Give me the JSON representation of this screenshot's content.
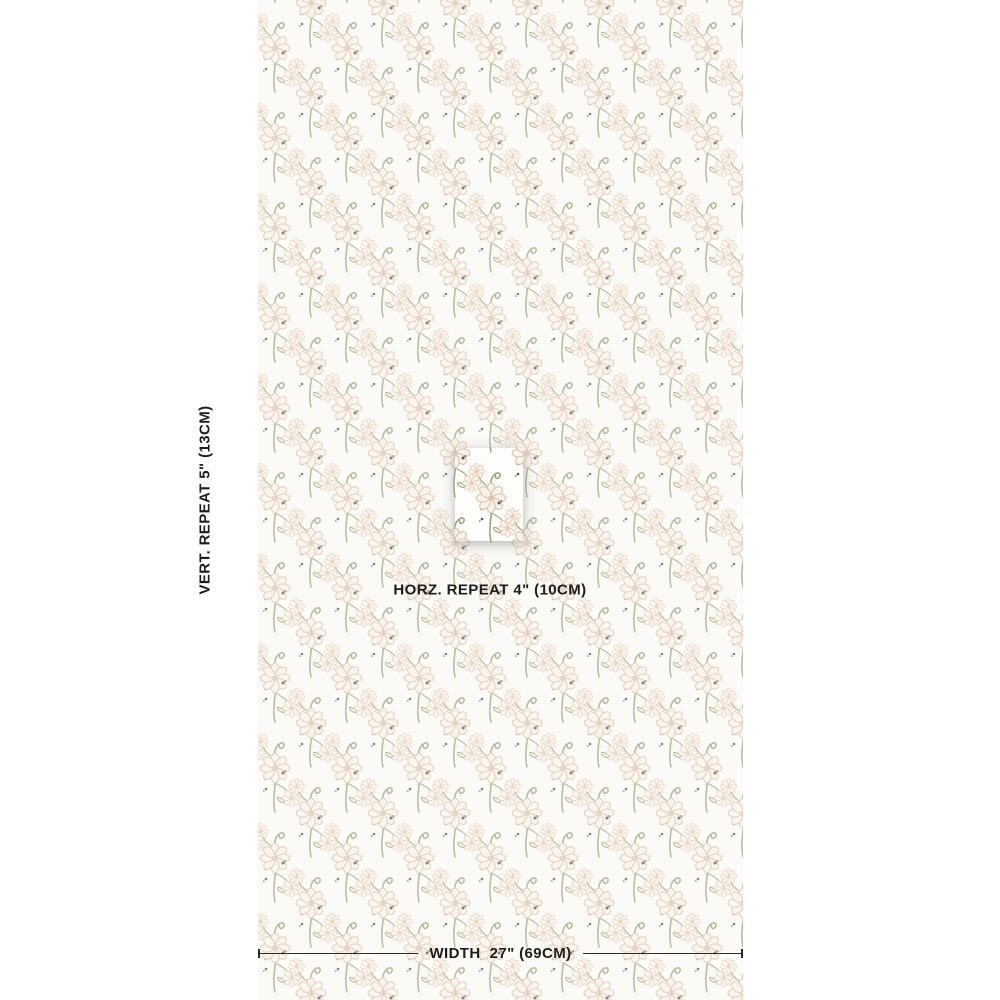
{
  "page": {
    "background": "#ffffff"
  },
  "swatch": {
    "background": "#fbfaf7",
    "description": "repeating block-print floral sprig pattern with curled stems and round scalloped-petal flowers",
    "colors": {
      "flower_outline": "#dfc3ac",
      "flower_fill": "#faf3ec",
      "stem": "#99a27b",
      "bud": "#575b40",
      "tile_background": "#fefdfb"
    },
    "repeat_tile": {
      "highlighted": true
    }
  },
  "annotations": {
    "vertical_repeat": "VERT. REPEAT 5\" (13CM)",
    "horizontal_repeat": "HORZ. REPEAT 4\" (10CM)",
    "width_label": "WIDTH",
    "width_value": "27\" (69CM)"
  }
}
